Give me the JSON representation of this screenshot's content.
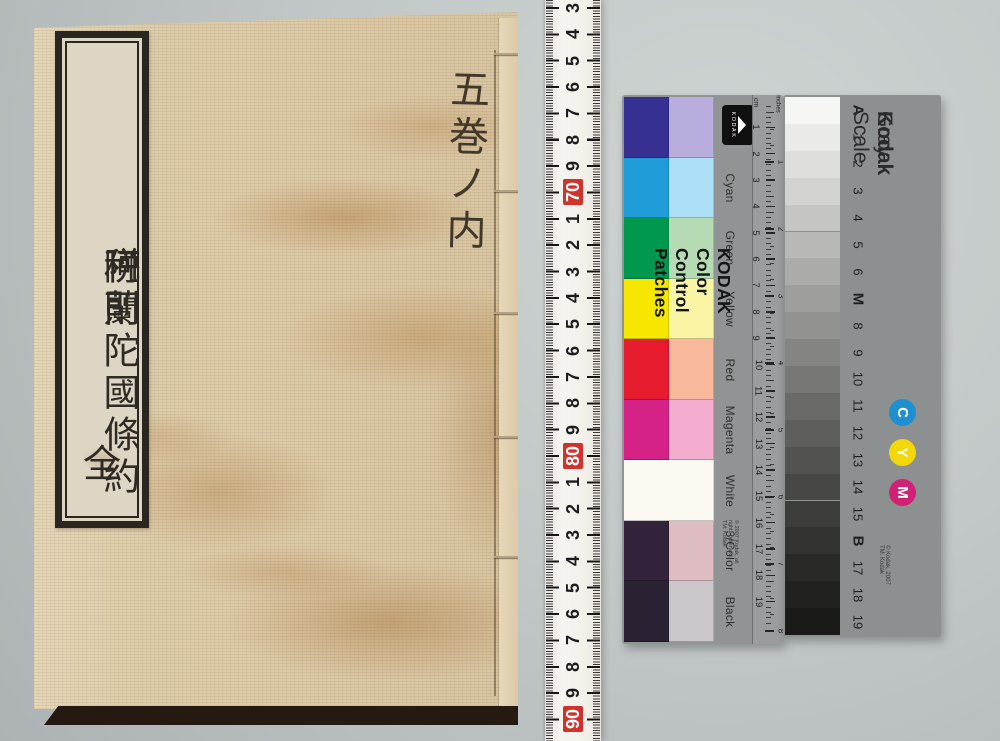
{
  "photo": {
    "background_top": "#ced4d2",
    "background_bottom": "#adb3b4",
    "book": {
      "cover_color": "#dbc9a6",
      "title_slip": {
        "line_main_1": "阿蘭陀國條約",
        "line_small": "並",
        "line_main_2": "税則",
        "line_bottom": "全"
      },
      "handwritten_note": "五巻ノ内"
    },
    "tape_ruler": {
      "red_color": "#cf332a",
      "numbers": [
        {
          "label": "3",
          "red": false
        },
        {
          "label": "4",
          "red": false
        },
        {
          "label": "5",
          "red": false
        },
        {
          "label": "6",
          "red": false
        },
        {
          "label": "7",
          "red": false
        },
        {
          "label": "8",
          "red": false
        },
        {
          "label": "9",
          "red": false
        },
        {
          "label": "70",
          "red": true
        },
        {
          "label": "1",
          "red": false
        },
        {
          "label": "2",
          "red": false
        },
        {
          "label": "3",
          "red": false
        },
        {
          "label": "4",
          "red": false
        },
        {
          "label": "5",
          "red": false
        },
        {
          "label": "6",
          "red": false
        },
        {
          "label": "7",
          "red": false
        },
        {
          "label": "8",
          "red": false
        },
        {
          "label": "9",
          "red": false
        },
        {
          "label": "80",
          "red": true
        },
        {
          "label": "1",
          "red": false
        },
        {
          "label": "2",
          "red": false
        },
        {
          "label": "3",
          "red": false
        },
        {
          "label": "4",
          "red": false
        },
        {
          "label": "5",
          "red": false
        },
        {
          "label": "6",
          "red": false
        },
        {
          "label": "7",
          "red": false
        },
        {
          "label": "8",
          "red": false
        },
        {
          "label": "9",
          "red": false
        },
        {
          "label": "90",
          "red": true
        }
      ]
    },
    "color_card": {
      "brand_logo_text": "KODAK",
      "title": "KODAK Color Control Patches",
      "copyright": "© 2007 Kodak, all rights reserved. TM: Kodak",
      "unit_cm": "cm",
      "unit_inches": "inches",
      "cm_numbers": [
        "1",
        "2",
        "3",
        "4",
        "5",
        "6",
        "7",
        "8",
        "9",
        "10",
        "11",
        "12",
        "13",
        "14",
        "15",
        "16",
        "17",
        "18",
        "19"
      ],
      "inch_numbers": [
        "1",
        "2",
        "3",
        "4",
        "5",
        "6",
        "7",
        "8"
      ],
      "rows": [
        {
          "name": "Blue",
          "dark": "#353092",
          "light": "#b9addd",
          "span": false
        },
        {
          "name": "Cyan",
          "dark": "#209dd9",
          "light": "#addff7",
          "span": false
        },
        {
          "name": "Green",
          "dark": "#00974f",
          "light": "#b6dab3",
          "span": false
        },
        {
          "name": "Yellow",
          "dark": "#f7e600",
          "light": "#faf5a5",
          "span": false
        },
        {
          "name": "Red",
          "dark": "#e61b2d",
          "light": "#f7b89c",
          "span": false
        },
        {
          "name": "Magenta",
          "dark": "#d52287",
          "light": "#f4accf",
          "span": false
        },
        {
          "name": "White",
          "dark": "#fbf9f1",
          "light": "#fbf9f1",
          "span": true
        },
        {
          "name": "3/Color",
          "dark": "#32223a",
          "light": "#ddbdc1",
          "span": false
        },
        {
          "name": "Black",
          "dark": "#2a2132",
          "light": "#cac6c9",
          "span": false
        }
      ]
    },
    "gray_card": {
      "brand": "Kodak",
      "title": " Gray Scale",
      "copyright": "© Kodak, 2007 TM: Kodak",
      "steps": [
        {
          "label": "A",
          "color": "#f6f6f4",
          "bold": true
        },
        {
          "label": "1",
          "color": "#eaeae8",
          "bold": false
        },
        {
          "label": "2",
          "color": "#dededc",
          "bold": false
        },
        {
          "label": "3",
          "color": "#d2d2d0",
          "bold": false
        },
        {
          "label": "4",
          "color": "#c5c5c3",
          "bold": false
        },
        {
          "label": "5",
          "color": "#b8b8b6",
          "bold": false
        },
        {
          "label": "6",
          "color": "#ababa9",
          "bold": false
        },
        {
          "label": "M",
          "color": "#9e9e9c",
          "bold": true
        },
        {
          "label": "8",
          "color": "#919190",
          "bold": false
        },
        {
          "label": "9",
          "color": "#848483",
          "bold": false
        },
        {
          "label": "10",
          "color": "#777776",
          "bold": false
        },
        {
          "label": "11",
          "color": "#6a6a69",
          "bold": false
        },
        {
          "label": "12",
          "color": "#5e5e5d",
          "bold": false
        },
        {
          "label": "13",
          "color": "#525251",
          "bold": false
        },
        {
          "label": "14",
          "color": "#474746",
          "bold": false
        },
        {
          "label": "15",
          "color": "#3c3c3b",
          "bold": false
        },
        {
          "label": "B",
          "color": "#323231",
          "bold": true
        },
        {
          "label": "17",
          "color": "#292928",
          "bold": false
        },
        {
          "label": "18",
          "color": "#212120",
          "bold": false
        },
        {
          "label": "19",
          "color": "#191918",
          "bold": false
        }
      ],
      "cym_circles": [
        {
          "letter": "C",
          "color": "#1e90d0"
        },
        {
          "letter": "Y",
          "color": "#f2d70b"
        },
        {
          "letter": "M",
          "color": "#cf2176"
        }
      ]
    }
  }
}
